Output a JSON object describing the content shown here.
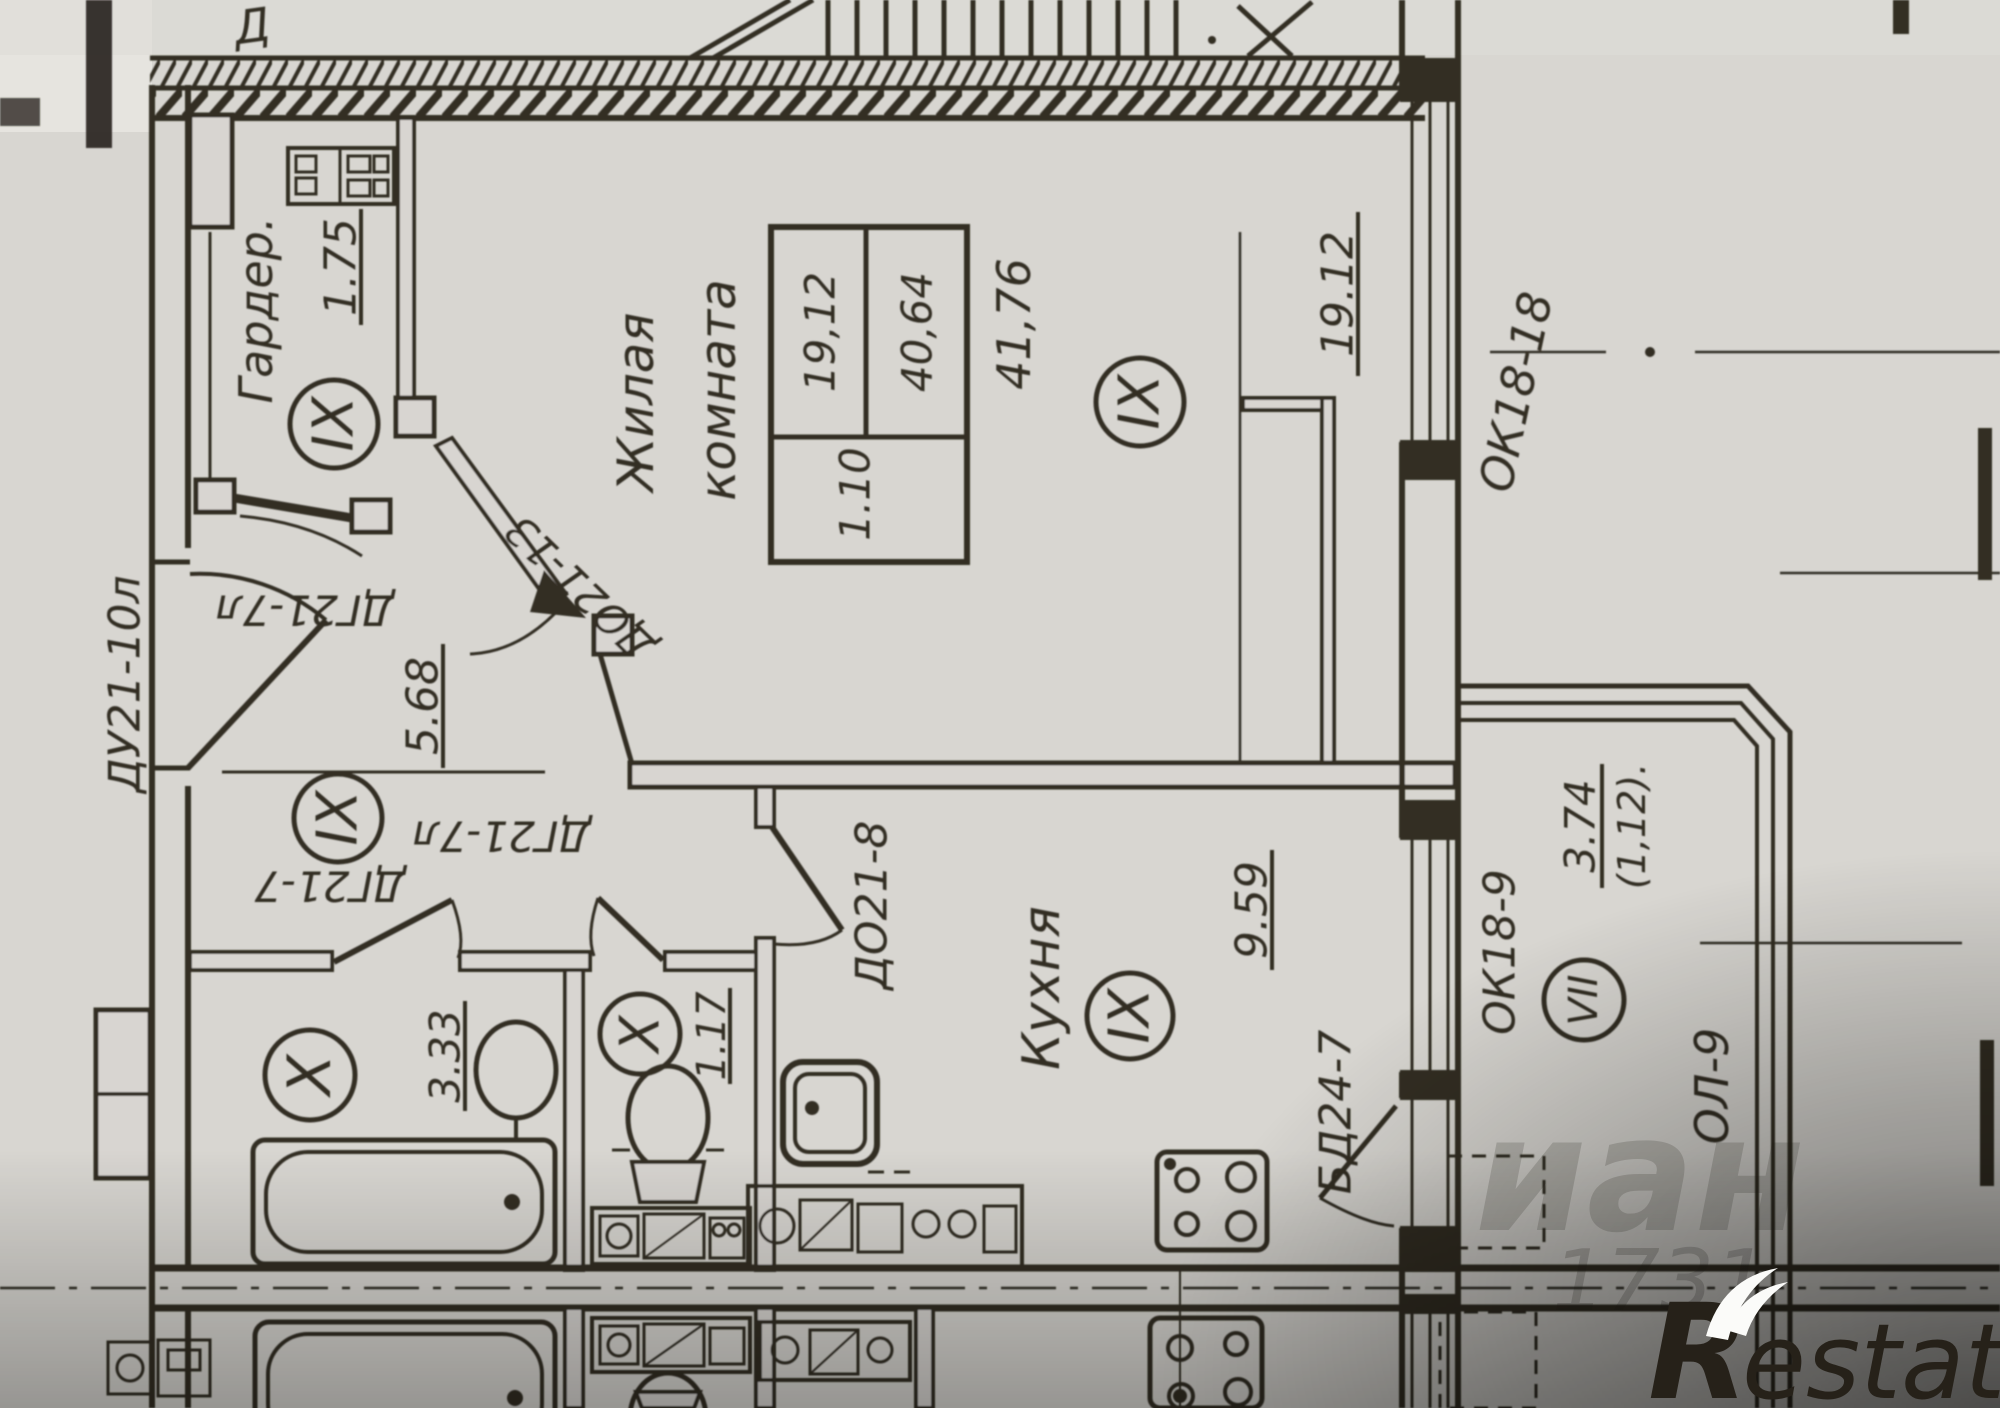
{
  "rooms": {
    "wardrobe": {
      "label": "Гардер.",
      "area": "1.75",
      "floor_mark": "IX"
    },
    "living_room": {
      "label_line1": "Жилая",
      "label_line2": "комната",
      "floor_mark": "IX",
      "dimension": "19.12",
      "area_table": {
        "cell_1": "19,12",
        "cell_2": "40,64",
        "cell_3": "1.10",
        "total": "41,76"
      }
    },
    "hall": {
      "area": "5.68",
      "floor_mark": "IX"
    },
    "bathroom": {
      "area": "3.33",
      "floor_mark": "X"
    },
    "wc": {
      "area": "1.17",
      "floor_mark": "X"
    },
    "kitchen": {
      "label": "Кухня",
      "area": "9.59",
      "floor_mark": "IX"
    },
    "loggia": {
      "area": "3.74",
      "area_secondary": "(1,12).",
      "floor_mark": "VII",
      "window_label": "ОЛ-9"
    }
  },
  "doors": {
    "entry": "ДУ21-10л",
    "wardrobe": "ДГ21-7л",
    "living": "ДО21-13",
    "bathroom": "ДГ21-7",
    "wc": "ДГ21-7л",
    "kitchen": "ДО21-8",
    "balcony": "БД24-7"
  },
  "windows": {
    "living": "ОК18-18",
    "kitchen": "ОК18-9"
  },
  "fragments": {
    "top_left_letter": "Д"
  },
  "watermarks": {
    "logo_r": "R",
    "logo_rest": "estate",
    "portal_fragment": "иан",
    "number_fragment": "1731"
  },
  "colors": {
    "ink": "#262119",
    "paper": "#d8d6d1"
  }
}
